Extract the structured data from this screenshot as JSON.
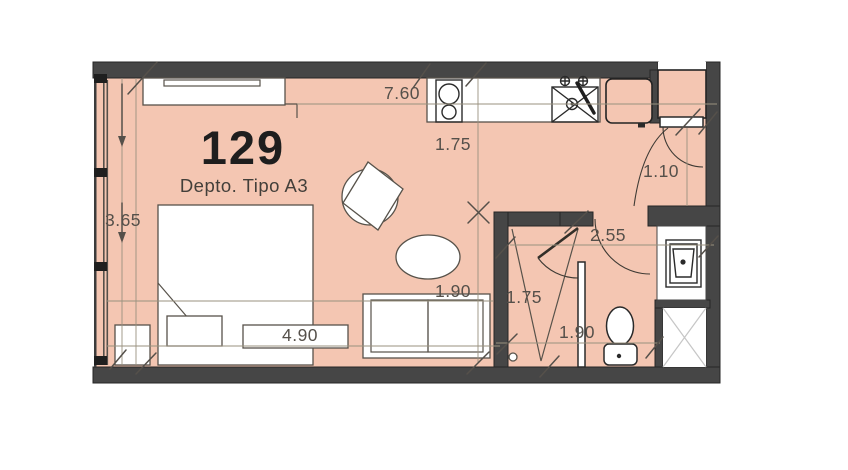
{
  "colors": {
    "floor": "#f4c6b2",
    "wall": "#464646",
    "wall_outline": "#262626",
    "furniture": "#ffffff",
    "furniture_outline": "#57524a",
    "fixture_outline": "#2a2a2a",
    "dim_line": "#99917f",
    "dim_text": "#55504a",
    "title_text": "#1e1e1e",
    "subtitle_text": "#433f3a",
    "shower_line": "#c6c6c6",
    "door_arc": "#3e3a34"
  },
  "plan": {
    "unit_number": "129",
    "unit_type_label": "Depto. Tipo A3",
    "dimensions": {
      "overall_width": "7.60",
      "kitchen_depth": "1.75",
      "window_length": "3.65",
      "bedroom_width": "4.90",
      "sofa_width": "1.90",
      "closet_depth": "1.75",
      "bathroom_width": "1.90",
      "bath_zone_width": "2.55",
      "entry_width": "1.10"
    }
  }
}
